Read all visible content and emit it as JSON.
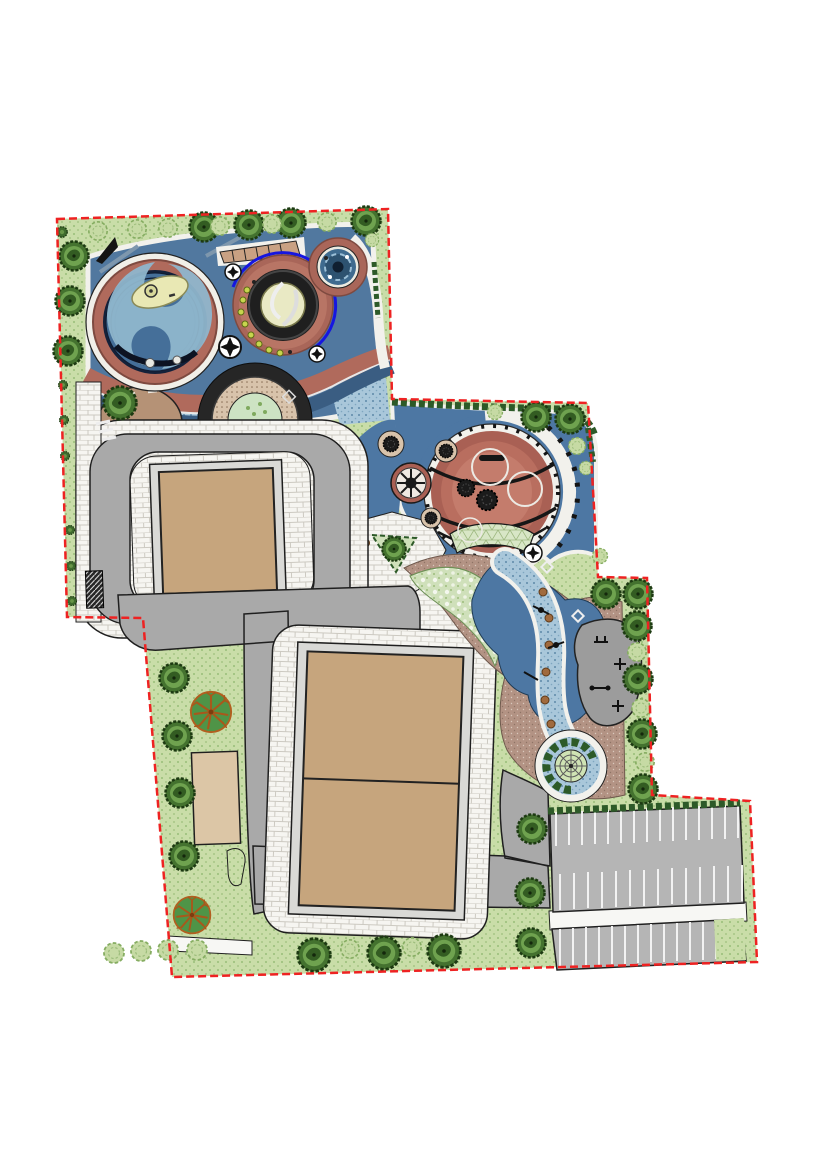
{
  "palette": {
    "background": "#ffffff",
    "boundary_red": "#ee2222",
    "plan_green": "#c9dda8",
    "green_dot": "#8ab46a",
    "hedge_green": "#2d5a28",
    "tree_green": "#44722f",
    "tree_highlight": "#6fa24f",
    "shrub_outline": "#86ad62",
    "ornamental_orange": "#b25f1f",
    "blue_plaza": "#51789f",
    "blue_mid": "#4d77a3",
    "blue_dark": "#16233c",
    "blue_navy_band": "#3a5d82",
    "blue_light_swirl": "#8fb6cc",
    "blue_dots_bg": "#a9c7da",
    "pool_blue": "#3f6b8f",
    "bright_blue_arc": "#1616e0",
    "terracotta": "#b06a5c",
    "terracotta_deep": "#a96054",
    "terracotta_ring": "#a96659",
    "terracotta_dark": "#7e4a40",
    "cream": "#e9e9c4",
    "island_cream": "#e9e8b4",
    "tan_court": "#c6a57d",
    "tan_building": "#dcc6a6",
    "stage_tan": "#b59276",
    "pergola_tan": "#c9a183",
    "brown_paver": "#b39384",
    "paver_white": "#f2f1ec",
    "road_gray": "#a9a9a9",
    "frame_gray": "#d9d9d6",
    "parking_gray": "#b5b5b5",
    "stall_white": "#f2f2f2",
    "fitness_gray": "#9c9c9c",
    "line_black": "#1f1f1f",
    "stepping_stone_brown": "#a06a3e",
    "mesh_green": "#d8e6c6",
    "speckle_green": "#cfe0ba",
    "amphitheater_tan": "#d8c3ab"
  },
  "counts": {
    "canopy_trees": 27,
    "shrub_clusters": 27,
    "small_hedge_shrubs": 7,
    "ornamental_trees": 2,
    "planter_trees": 5,
    "parking_stalls_upper_row1": 15,
    "parking_stalls_upper_row2": 14,
    "parking_stalls_lower_strip": 14,
    "courts_upper_block": 1,
    "courts_lower_block": 2,
    "circular_plazas": 3
  }
}
